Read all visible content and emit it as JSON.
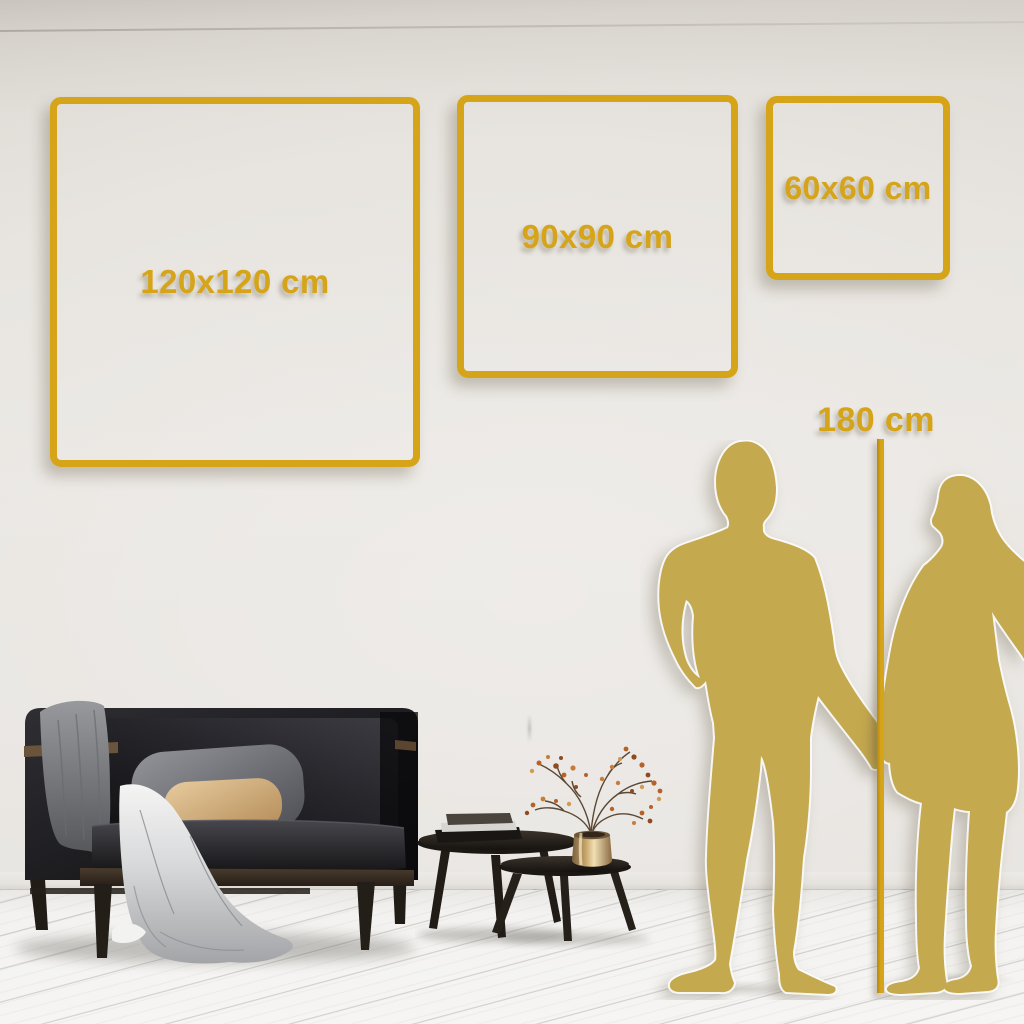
{
  "frames": {
    "items": [
      {
        "label": "120x120 cm",
        "width_cm": 120,
        "height_cm": 120
      },
      {
        "label": "90x90 cm",
        "width_cm": 90,
        "height_cm": 90
      },
      {
        "label": "60x60 cm",
        "width_cm": 60,
        "height_cm": 60
      }
    ]
  },
  "height_marker": {
    "label": "180 cm",
    "height_cm": 180
  },
  "colors": {
    "gold_accent": "#D6A419",
    "silhouette_gold": "#C5A94F",
    "wall": "#E8E5E1",
    "floor": "#F4F3F1",
    "sofa_dark": "#17171A",
    "pillow_gray": "#85868A",
    "pillow_tan": "#D9BA8C",
    "blanket_gray": "#96979A",
    "wood_dark": "#2E2823",
    "vase_brass": "#D6B98B",
    "plant_rust": "#B5622A"
  },
  "scene": {
    "silhouettes": [
      "man",
      "woman"
    ],
    "furniture": [
      "sofa-with-throw-blanket",
      "nesting-coffee-tables",
      "books",
      "vase-with-dried-branch"
    ]
  }
}
